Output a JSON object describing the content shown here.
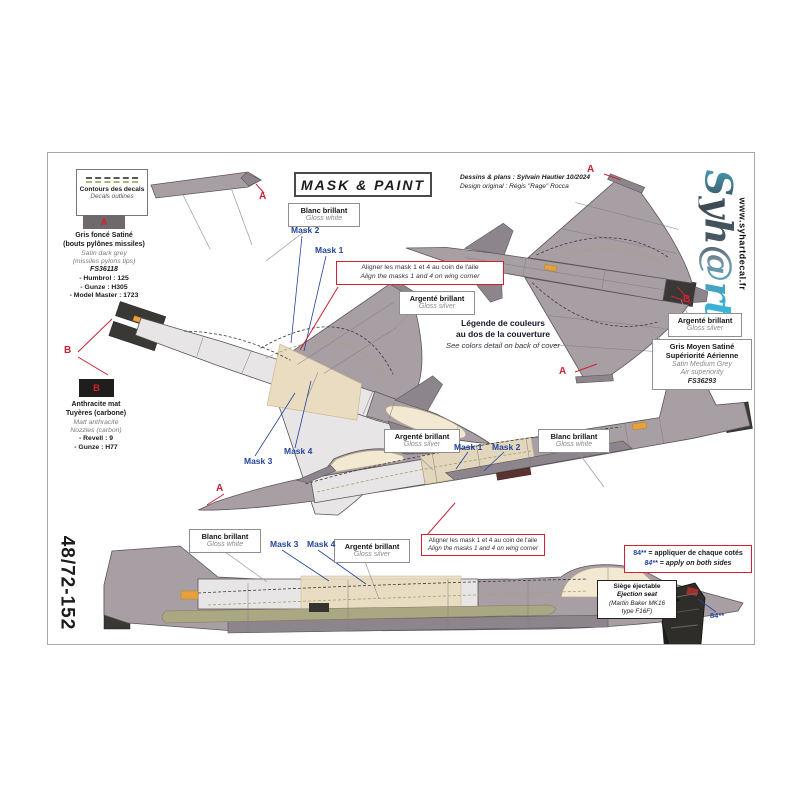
{
  "sheet": {
    "code": "48/72-152",
    "title": "MASK & PAINT",
    "credit1": "Dessins & plans : Sylvain Hautier 10/2024",
    "credit2": "Design original : Régis \"Rage\" Rocca",
    "logo": "Syh@rt",
    "website": "www.syhartdecal.fr"
  },
  "legend_box": {
    "fr": "Contours des decals",
    "en": "Decals outlines"
  },
  "marker_a": "A",
  "marker_b": "B",
  "swatch_a": {
    "letter": "A",
    "fr1": "Gris foncé Satiné",
    "fr2": "(bouts pylônes missiles)",
    "en1": "Satin dark grey",
    "en2": "(missiles pylons tips)",
    "fs": "FS36118",
    "paint1": "- Humbrol : 125",
    "paint2": "- Gunze : H305",
    "paint3": "- Model Master : 1723"
  },
  "swatch_b": {
    "letter": "B",
    "fr1": "Anthracite mat",
    "fr2": "Tuyères (carbone)",
    "en1": "Matt anthracite",
    "en2": "Nozzles (carbon)",
    "paint1": "- Revell : 9",
    "paint2": "- Gunze : H77"
  },
  "labels": {
    "gloss_white": {
      "fr": "Blanc brillant",
      "en": "Gloss white"
    },
    "gloss_silver": {
      "fr": "Argenté brillant",
      "en": "Gloss silver"
    },
    "medium_grey": {
      "fr1": "Gris Moyen Satiné",
      "fr2": "Supériorité Aérienne",
      "en1": "Satin Medium Grey",
      "en2": "Air superiority",
      "fs": "FS36293"
    }
  },
  "masks": {
    "m1": "Mask 1",
    "m2": "Mask 2",
    "m3": "Mask 3",
    "m4": "Mask 4"
  },
  "align_note": {
    "fr": "Aligner les mask 1 et 4 au coin de l'aile",
    "en": "Align the masks 1 and 4 on wing corner"
  },
  "color_note": {
    "fr1": "Légende de couleurs",
    "fr2": "au dos de la couverture",
    "en": "See colors detail on back of cover"
  },
  "both_sides_note": {
    "code": "84**",
    "fr": " = appliquer de chaque cotés",
    "en": " = apply on both sides"
  },
  "seat": {
    "fr": "Siège éjectable",
    "en": "Ejection seat",
    "detail1": "(Martin Baker MK16",
    "detail2": "type F16F)",
    "code": "84**"
  },
  "colors": {
    "accent_red": "#cc2233",
    "mask_blue": "#24459e",
    "airframe_grey": "#a89fa5",
    "mask_beige": "#e9dcc0",
    "canopy_cream": "#f3e9d2",
    "nozzle_dark": "#3a3835"
  }
}
